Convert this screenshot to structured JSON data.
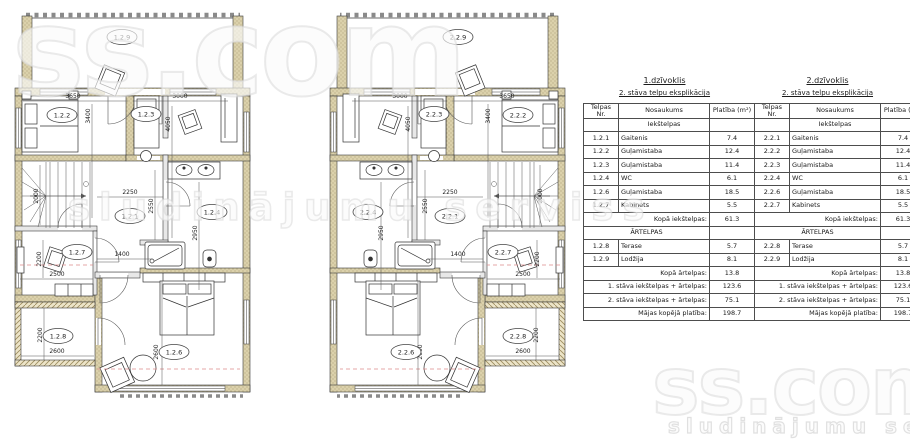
{
  "watermark": {
    "brand": "ss.com",
    "tagline": "sludinājumu serviss"
  },
  "plan_dims": {
    "w3650": "3650",
    "w3000": "3000",
    "h3400": "3400",
    "h4050": "4050",
    "hall_w": "2250",
    "hall_h": "2550",
    "wc_h": "2950",
    "d1400": "1400",
    "kab_w": "2500",
    "kab_h": "2200",
    "stairs_h": "2000",
    "ter_h": "2200",
    "ter_w": "2600",
    "bed_h": "2600"
  },
  "plan_left": {
    "rooms": {
      "lodzija": "1.2.9",
      "bedroom1": "1.2.2",
      "bedroom2": "1.2.3",
      "hall": "1.2.1",
      "wc": "1.2.4",
      "kabinets": "1.2.7",
      "terase": "1.2.8",
      "bedroom3": "1.2.6"
    }
  },
  "plan_right": {
    "rooms": {
      "lodzija": "2.2.9",
      "bedroom1": "2.2.2",
      "bedroom2": "2.2.3",
      "hall": "2.2.1",
      "wc": "2.2.4",
      "kabinets": "2.2.7",
      "terase": "2.2.8",
      "bedroom3": "2.2.6"
    }
  },
  "explication": {
    "col_headers": {
      "nr": "Telpas Nr.",
      "name": "Nosaukums",
      "area": "Platība (m²)"
    },
    "apartments": [
      {
        "title": "1.dzīvoklis",
        "subtitle": "2. stāva telpu eksplikācija",
        "indoor_section": "Iekštelpas",
        "rows": [
          {
            "nr": "1.2.1",
            "name": "Gaitenis",
            "area": "7.4"
          },
          {
            "nr": "1.2.2",
            "name": "Guļamistaba",
            "area": "12.4"
          },
          {
            "nr": "1.2.3",
            "name": "Guļamistaba",
            "area": "11.4"
          },
          {
            "nr": "1.2.4",
            "name": "WC",
            "area": "6.1"
          },
          {
            "nr": "1.2.6",
            "name": "Guļamistaba",
            "area": "18.5"
          },
          {
            "nr": "1.2.7",
            "name": "Kabinets",
            "area": "5.5"
          }
        ],
        "indoor_total_label": "Kopā iekštelpas:",
        "indoor_total": "61.3",
        "outdoor_section": "ĀRTELPAS",
        "outdoor_rows": [
          {
            "nr": "1.2.8",
            "name": "Terase",
            "area": "5.7"
          },
          {
            "nr": "1.2.9",
            "name": "Lodžija",
            "area": "8.1"
          }
        ],
        "outdoor_total_label": "Kopā ārtelpas:",
        "outdoor_total": "13.8",
        "floor1_label": "1. stāva iekštelpas + ārtelpas:",
        "floor1": "123.6",
        "floor2_label": "2. stāva iekštelpas + ārtelpas:",
        "floor2": "75.1",
        "house_label": "Mājas kopējā platība:",
        "house": "198.7"
      },
      {
        "title": "2.dzīvoklis",
        "subtitle": "2. stāva telpu eksplikācija",
        "indoor_section": "Iekštelpas",
        "rows": [
          {
            "nr": "2.2.1",
            "name": "Gaitenis",
            "area": "7.4"
          },
          {
            "nr": "2.2.2",
            "name": "Guļamistaba",
            "area": "12.4"
          },
          {
            "nr": "2.2.3",
            "name": "Guļamistaba",
            "area": "11.4"
          },
          {
            "nr": "2.2.4",
            "name": "WC",
            "area": "6.1"
          },
          {
            "nr": "2.2.6",
            "name": "Guļamistaba",
            "area": "18.5"
          },
          {
            "nr": "2.2.7",
            "name": "Kabinets",
            "area": "5.5"
          }
        ],
        "indoor_total_label": "Kopā iekštelpas:",
        "indoor_total": "61.3",
        "outdoor_section": "ĀRTELPAS",
        "outdoor_rows": [
          {
            "nr": "2.2.8",
            "name": "Terase",
            "area": "5.7"
          },
          {
            "nr": "2.2.9",
            "name": "Lodžija",
            "area": "8.1"
          }
        ],
        "outdoor_total_label": "Kopā ārtelpas:",
        "outdoor_total": "13.8",
        "floor1_label": "1. stāva iekštelpas + ārtelpas:",
        "floor1": "123.6",
        "floor2_label": "2. stāva iekštelpas + ārtelpas:",
        "floor2": "75.1",
        "house_label": "Mājas kopējā platība:",
        "house": "198.7"
      }
    ]
  }
}
